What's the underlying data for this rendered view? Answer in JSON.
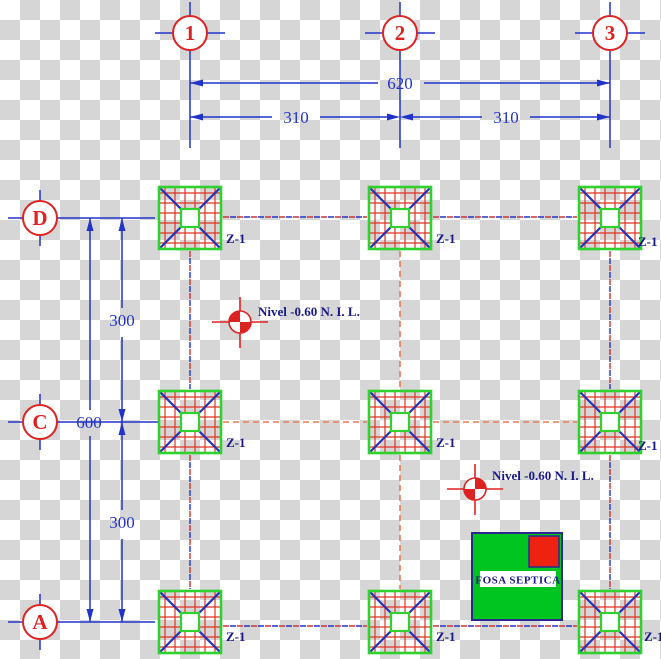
{
  "drawing": {
    "title": "foundation-plan",
    "grid": {
      "cols": [
        {
          "label": "1"
        },
        {
          "label": "2"
        },
        {
          "label": "3"
        }
      ],
      "rows": [
        {
          "label": "D"
        },
        {
          "label": "C"
        },
        {
          "label": "A"
        }
      ]
    },
    "dimensions": {
      "top_total": "620",
      "top_left": "310",
      "top_right": "310",
      "left_total": "600",
      "left_upper": "300",
      "left_lower": "300"
    },
    "footing_label": "Z-1",
    "level_note": "Nivel -0.60 N. I. L.",
    "fosa_label": "FOSA SEPTICA",
    "colors": {
      "line_blue": "#2233cc",
      "accent_red": "#dd2222",
      "rebar_red": "#e03322",
      "footing_green": "#2fd12f",
      "fosa_green": "#00c520",
      "navy_text": "#18188a",
      "dash_orange": "#e87a55",
      "checker_gray": "#d6d6d6"
    }
  }
}
